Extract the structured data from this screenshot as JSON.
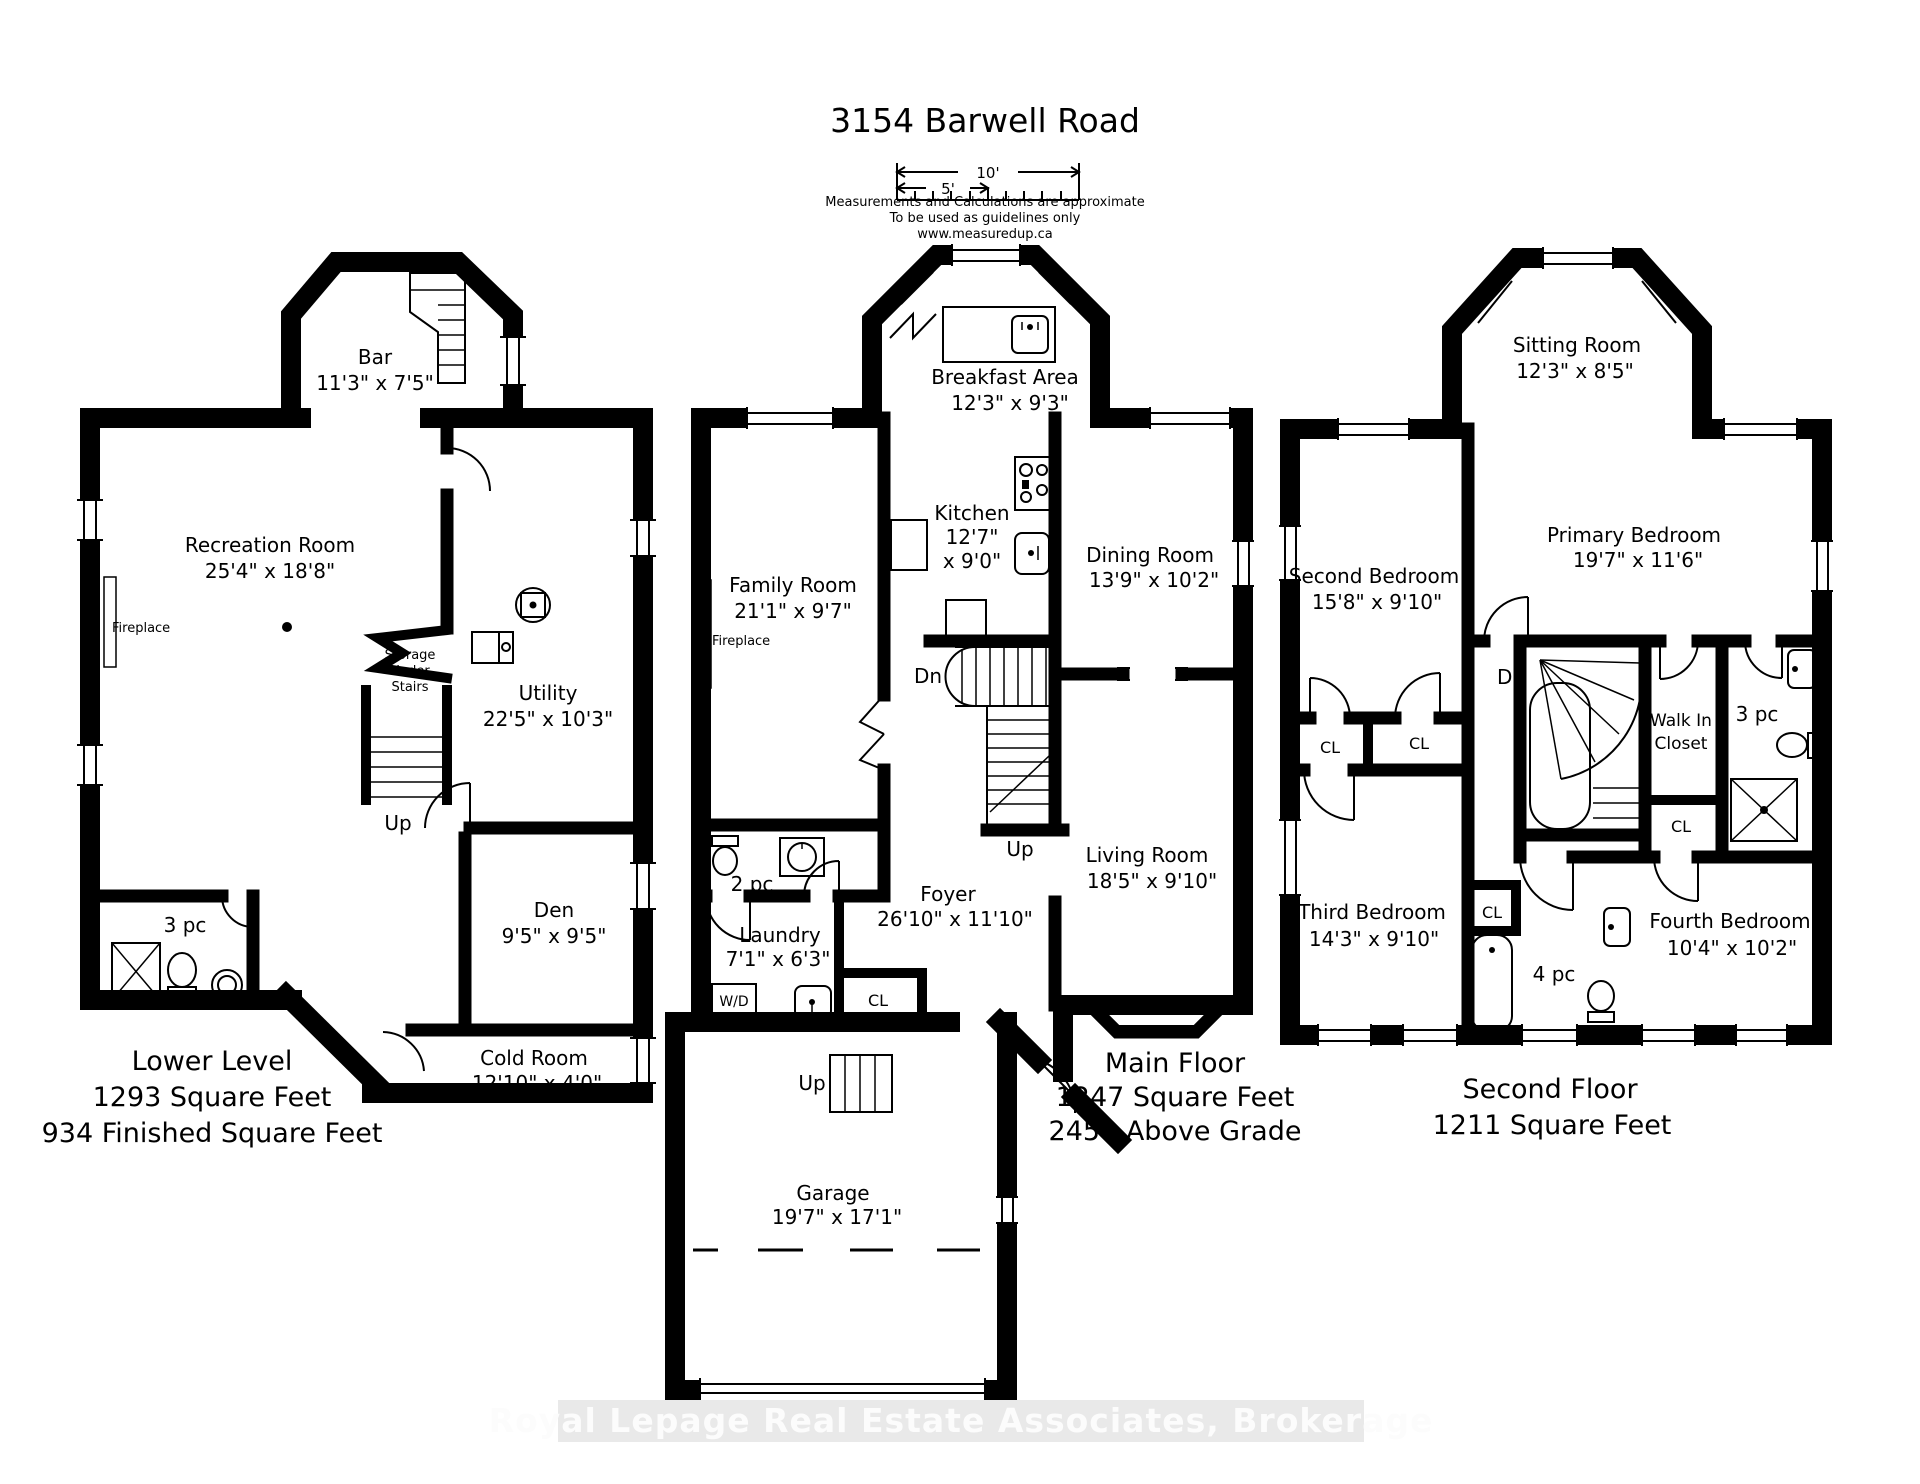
{
  "header": {
    "title": "3154 Barwell Road",
    "scale_10": "10'",
    "scale_5": "5'",
    "notes": [
      "Measurements and Calculations are approximate",
      "To be used as guidelines only",
      "www.measuredup.ca"
    ]
  },
  "lower": {
    "bar": {
      "name": "Bar",
      "dims": "11'3\" x 7'5\""
    },
    "recreation": {
      "name": "Recreation Room",
      "dims": "25'4\" x 18'8\""
    },
    "fireplace": "Fireplace",
    "storage": [
      "Storage",
      "Under",
      "Stairs"
    ],
    "utility": {
      "name": "Utility",
      "dims": "22'5\" x 10'3\""
    },
    "up": "Up",
    "den": {
      "name": "Den",
      "dims": "9'5\" x 9'5\""
    },
    "bath": "3 pc",
    "cold": {
      "name": "Cold Room",
      "dims": "12'10\" x 4'0\""
    },
    "summary": [
      "Lower Level",
      "1293 Square Feet",
      "934 Finished Square Feet"
    ]
  },
  "main": {
    "breakfast": {
      "name": "Breakfast Area",
      "dims": "12'3\" x 9'3\""
    },
    "kitchen": {
      "name": "Kitchen",
      "dims1": "12'7\"",
      "dims2": "x 9'0\""
    },
    "family": {
      "name": "Family Room",
      "dims": "21'1\" x 9'7\""
    },
    "fireplace": "Fireplace",
    "dining": {
      "name": "Dining Room",
      "dims": "13'9\" x 10'2\""
    },
    "dn": "Dn",
    "up": "Up",
    "up_garage": "Up",
    "living": {
      "name": "Living Room",
      "dims": "18'5\" x 9'10\""
    },
    "bath": "2 pc",
    "foyer": {
      "name": "Foyer",
      "dims": "26'10\" x 11'10\""
    },
    "laundry": {
      "name": "Laundry",
      "dims": "7'1\" x 6'3\""
    },
    "wd": "W/D",
    "cl": "CL",
    "garage": {
      "name": "Garage",
      "dims": "19'7\" x 17'1\""
    },
    "summary": [
      "Main Floor",
      "1247 Square Feet",
      "2458 Above Grade"
    ]
  },
  "second": {
    "sitting": {
      "name": "Sitting Room",
      "dims": "12'3\" x 8'5\""
    },
    "second_bedroom": {
      "name": "Second Bedroom",
      "dims": "15'8\" x 9'10\""
    },
    "primary": {
      "name": "Primary Bedroom",
      "dims": "19'7\" x 11'6\""
    },
    "dn": "Dn",
    "walkin": [
      "Walk In",
      "Closet"
    ],
    "bath3": "3 pc",
    "cl1": "CL",
    "cl2": "CL",
    "cl3": "CL",
    "cl4": "CL",
    "third_bedroom": {
      "name": "Third Bedroom",
      "dims": "14'3\" x 9'10\""
    },
    "bath4": "4 pc",
    "fourth_bedroom": {
      "name": "Fourth Bedroom",
      "dims": "10'4\" x 10'2\""
    },
    "summary": [
      "Second Floor",
      "1211 Square Feet"
    ]
  },
  "watermark": "Royal Lepage Real Estate Associates, Brokerage"
}
